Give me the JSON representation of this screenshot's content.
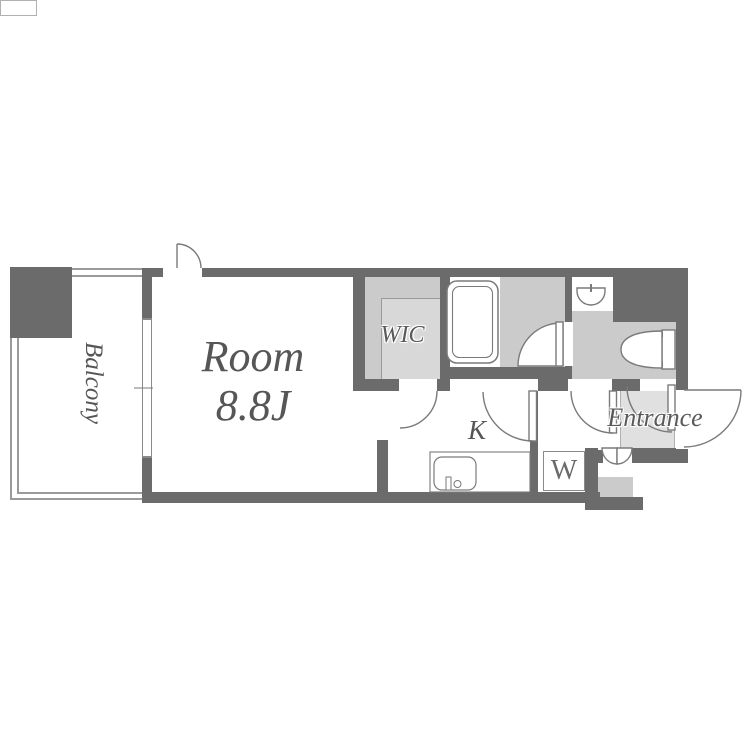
{
  "title": "Apartment floor plan",
  "labels": {
    "room": "Room",
    "room_size": "8.8J",
    "balcony": "Balcony",
    "wic": "WIC",
    "kitchen": "K",
    "washer": "W",
    "entrance": "Entrance"
  },
  "colors": {
    "wall": "#6b6b6b",
    "floor_gray": "#cbcbcb",
    "floor_light_gray": "#d8d8d8",
    "entrance_gray": "#e0e0e0",
    "outline": "#7a7a7a",
    "thin_line": "#9a9a9a",
    "text": "#565656",
    "background": "#ffffff"
  }
}
